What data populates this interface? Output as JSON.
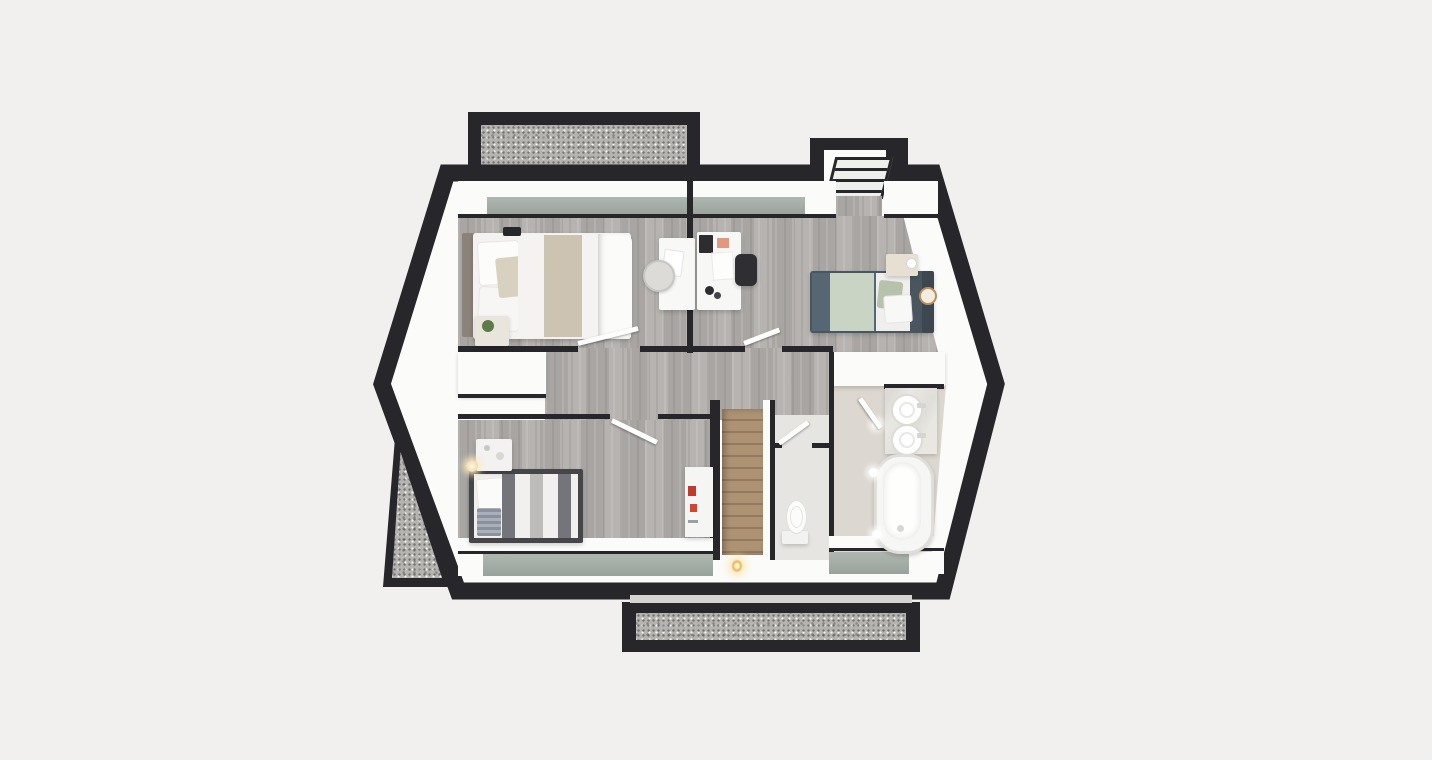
{
  "meta": {
    "title": "3D floor plan render — upper floor, top-down view",
    "view": "top-down 3D dollhouse render",
    "canvas": {
      "width": 1432,
      "height": 760
    },
    "visible_text": "none"
  },
  "palette": {
    "bg": "#f1f0ee",
    "wall_dark": "#26262b",
    "shell_white": "#fbfbfa",
    "floor_wood": "#b1aeab",
    "floor_bath": "#dcd7d0",
    "floor_wc": "#e7e5e1",
    "glass_hi": "#aeb7b0",
    "glass_lo": "#99a29b",
    "gravel": "#b6b4b1",
    "stair_wood": "#ad9274",
    "stair_riser": "#947a5e",
    "bed_teal": "#566672",
    "bed_sage": "#c9d4c5",
    "bed_beige": "#ccc3b0",
    "bed3_frame": "#45454a",
    "accent_red": "#c23a2c",
    "clock_gold": "#bb8e5c",
    "plant_green": "#5d7a4a"
  },
  "rooms": [
    {
      "id": "bedroom-master",
      "label": "Master bedroom",
      "floor": "wood",
      "position": "top-left"
    },
    {
      "id": "bedroom-2",
      "label": "Bedroom 2",
      "floor": "wood",
      "position": "top-right"
    },
    {
      "id": "bedroom-3",
      "label": "Bedroom 3",
      "floor": "wood",
      "position": "bottom-left"
    },
    {
      "id": "hallway",
      "label": "Hallway / landing",
      "floor": "wood",
      "position": "center"
    },
    {
      "id": "stairwell",
      "label": "Stairwell going down",
      "floor": "wood-stairs",
      "position": "center"
    },
    {
      "id": "wc",
      "label": "WC",
      "floor": "light",
      "position": "bottom-center"
    },
    {
      "id": "bathroom",
      "label": "Bathroom",
      "floor": "stone",
      "position": "bottom-right"
    }
  ],
  "furniture": {
    "bedroom_master": [
      "double bed with white/beige bedding",
      "headboard",
      "two pillows + beige accent pillow",
      "nightstand with plant",
      "wall lamp",
      "small desk",
      "round chair"
    ],
    "bedroom_2": [
      "single bed with teal and sage bedding",
      "nightstand with lamp",
      "round gold wall clock",
      "white desk",
      "black office chair",
      "laptop",
      "coffee mugs"
    ],
    "bedroom_3": [
      "single bed with grey striped duvet",
      "dresser",
      "wall lamp",
      "white shelf with red books"
    ],
    "bathroom": [
      "double vanity with two round sinks",
      "bathtub",
      "three ceiling spotlights",
      "open door"
    ],
    "wc": [
      "toilet"
    ],
    "stairwell": [
      "wooden staircase",
      "candle light at base"
    ]
  },
  "exterior": {
    "terrace_top": "gravel terrace with dark parapet, top-left",
    "terrace_bottom": "gravel terrace with dark parapet, bottom-center",
    "gravel_wedge": "triangular gravel roof section, lower-left",
    "dormer": "dormer with slanted glazed window, top-right",
    "window_band_top": "green-tinted glazing strip along top wall",
    "window_band_bottom": "green-tinted knee-wall glazing strips along bottom wall",
    "open_doors": 5
  }
}
